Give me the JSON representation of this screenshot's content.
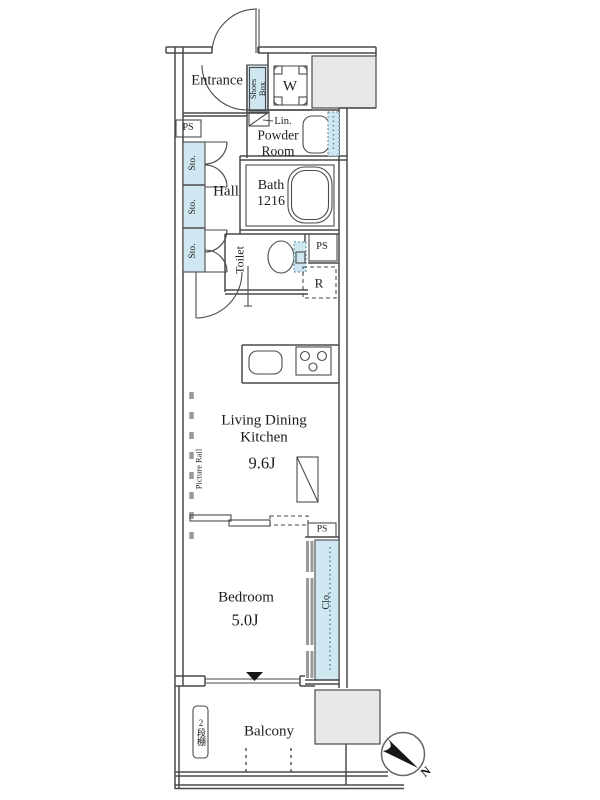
{
  "colors": {
    "wall_line": "#4a4a4a",
    "fixture_fill": "#cfe7f1",
    "shaded_fill": "#e8e8e8",
    "fixture_dots": "#5b8aa6",
    "marker_black": "#161616"
  },
  "labels": {
    "entrance": "Entrance",
    "shoes_box": [
      "Shoes",
      "Box"
    ],
    "washing_machine": "W",
    "linen": "Lin.",
    "powder_room": [
      "Powder",
      "Room"
    ],
    "pipe_space": "PS",
    "storage": "Sto.",
    "hall": "Hall",
    "bath": [
      "Bath",
      "1216"
    ],
    "toilet": "Toilet",
    "refrigerator": "R",
    "living_dining_kitchen": [
      "Living Dining",
      "Kitchen"
    ],
    "ldk_size": "9.6J",
    "picture_rail": "Picture Rail",
    "bedroom": "Bedroom",
    "bedroom_size": "5.0J",
    "closet": "Clo.",
    "balcony": "Balcony",
    "balcony_shelf": "2段棚",
    "north": "N"
  }
}
